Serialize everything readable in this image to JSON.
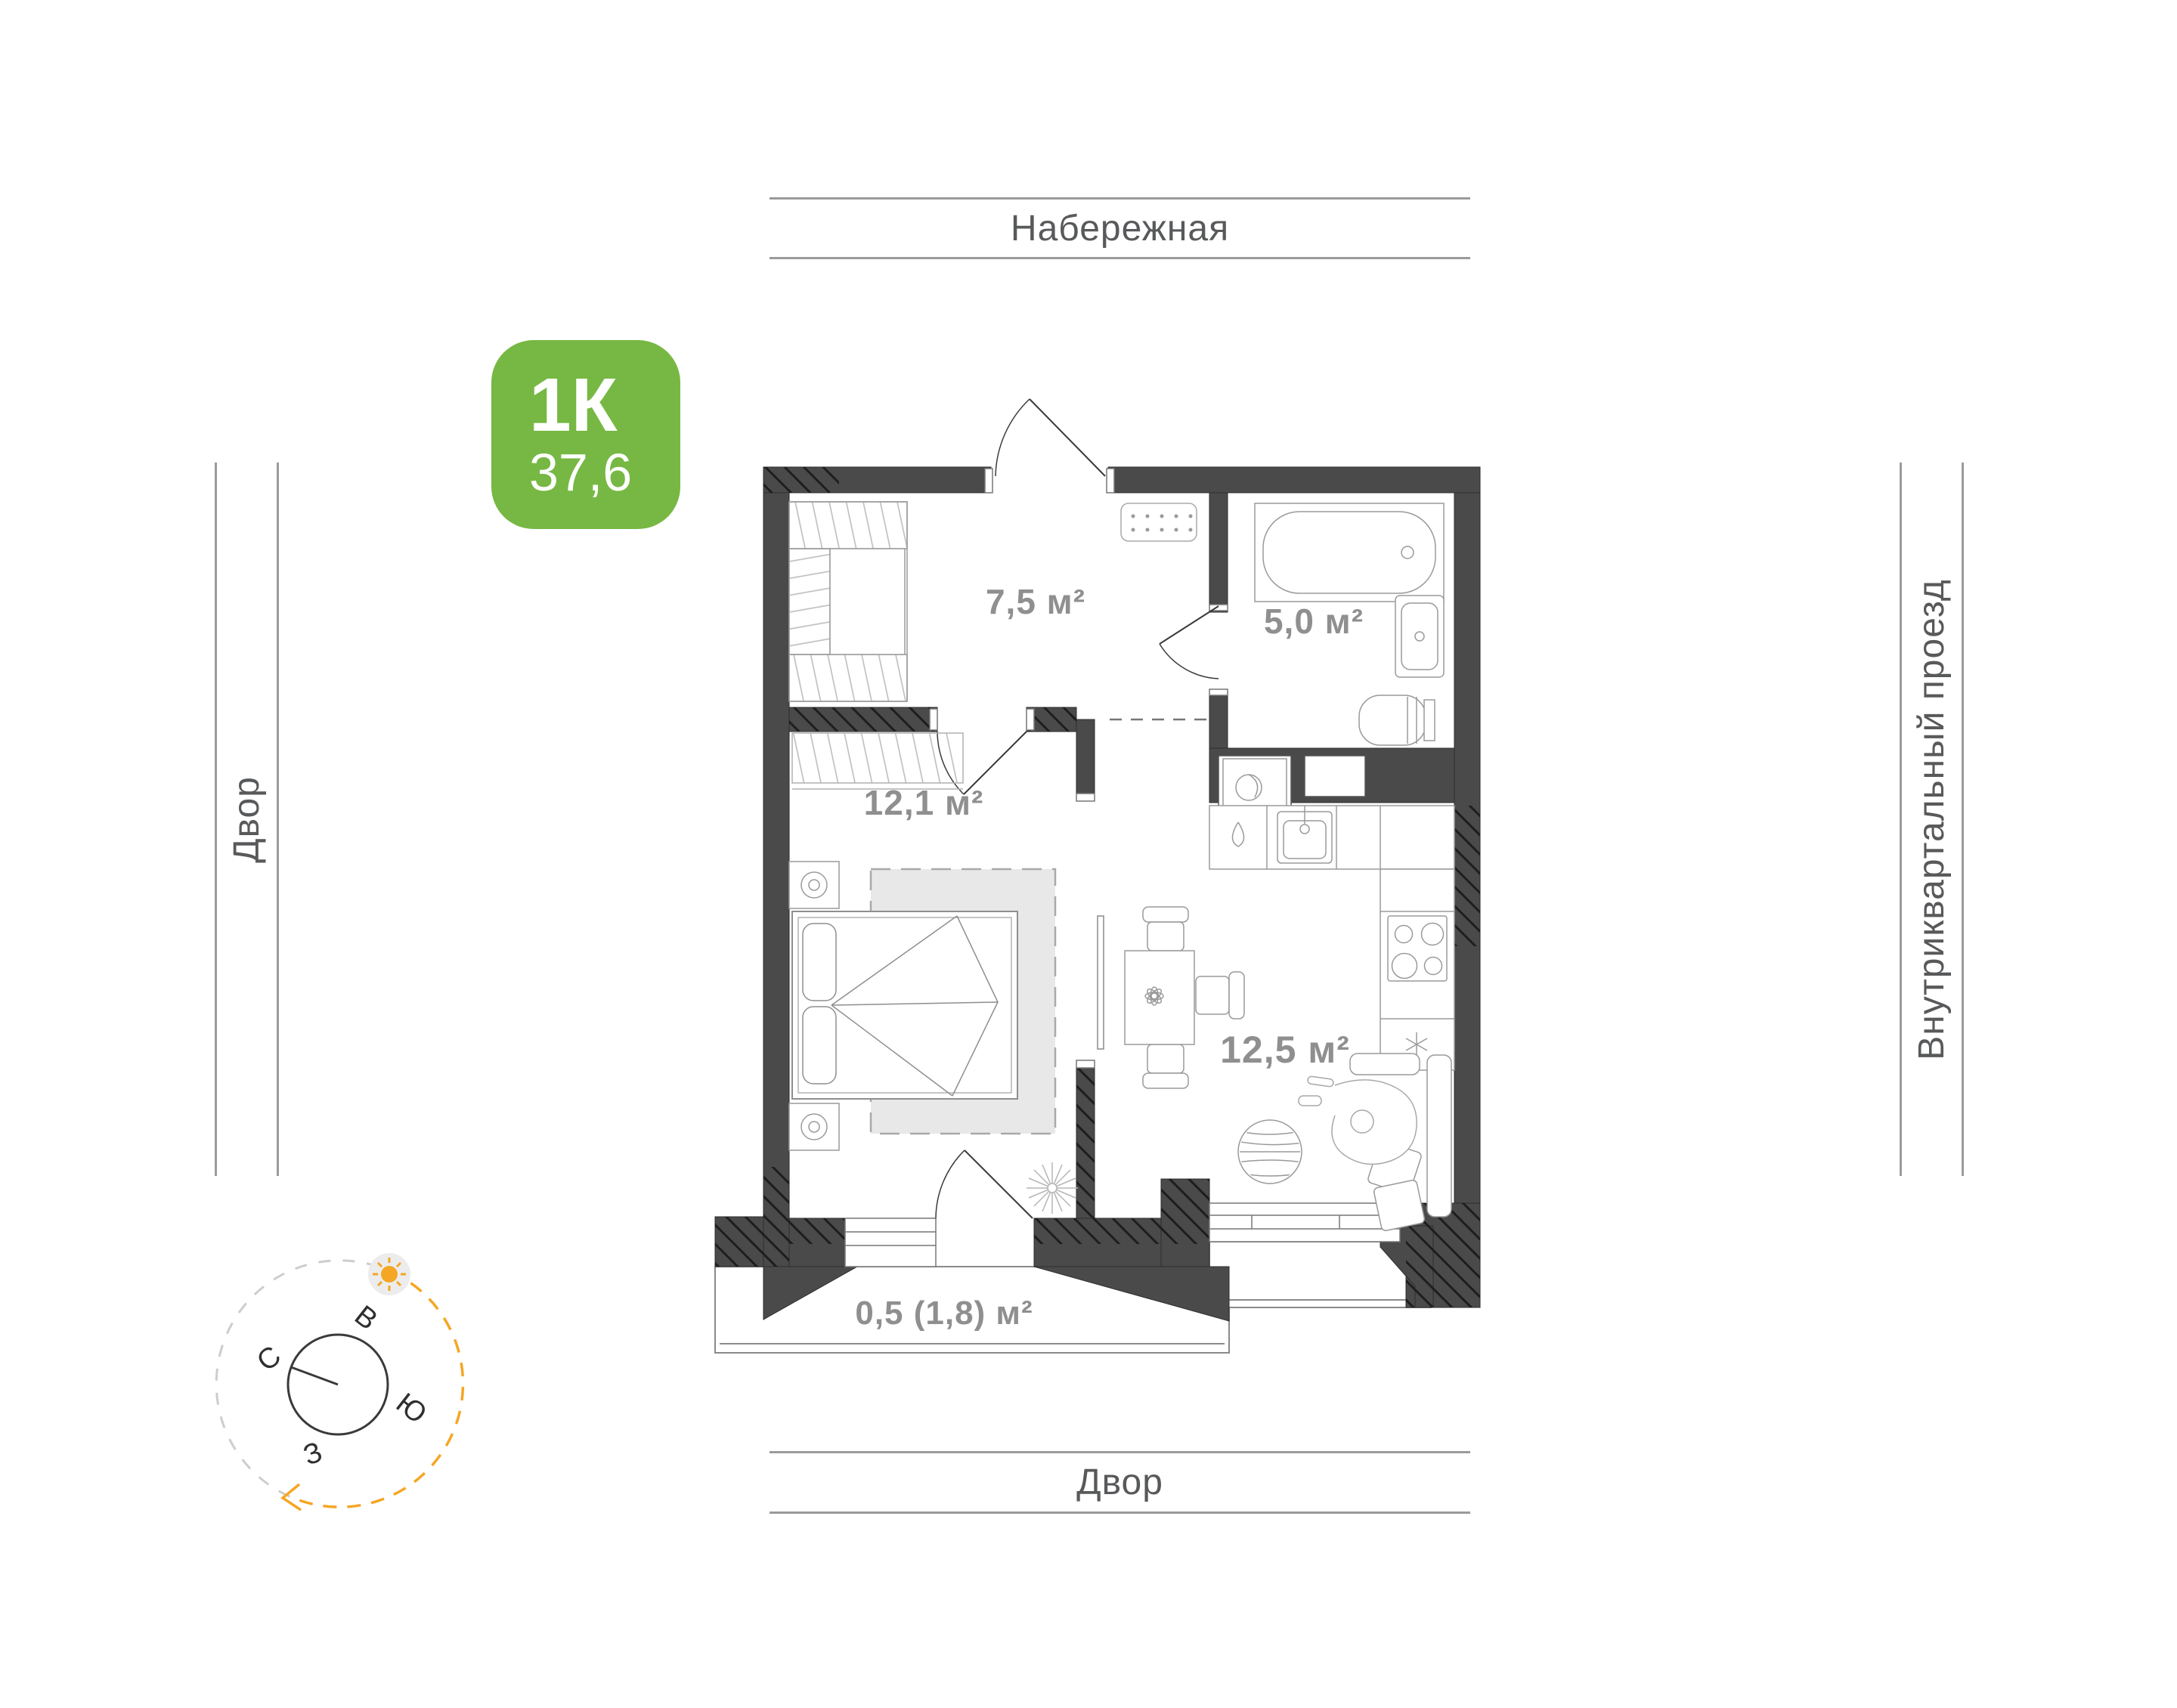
{
  "streets": {
    "top": "Набережная",
    "bottom": "Двор",
    "left": "Двор",
    "right": "Внутриквартальный проезд"
  },
  "badge": {
    "rooms_label": "1К",
    "area_value": "37,6",
    "color": "#76B843"
  },
  "rooms": {
    "hallway": {
      "area_label": "7,5 м²"
    },
    "bathroom": {
      "area_label": "5,0 м²"
    },
    "bedroom": {
      "area_label": "12,1 м²"
    },
    "kitchen_living": {
      "area_label": "12,5 м²"
    },
    "balcony": {
      "area_label": "0,5 (1,8) м²"
    }
  },
  "compass": {
    "north": "С",
    "east": "В",
    "south": "Ю",
    "west": "З",
    "sun_color": "#F5A623",
    "active_arc_color": "#F5A623",
    "inactive_arc_color": "#CDCDCD"
  },
  "colors": {
    "wall": "#4A4A4A",
    "wall_hatch": "#1E1E1E",
    "furniture_line": "#9A9A9A",
    "area_label": "#8F8F8F",
    "street_label": "#58595B",
    "street_line": "#9B9B9B",
    "rug_fill": "#E8E8E8"
  }
}
